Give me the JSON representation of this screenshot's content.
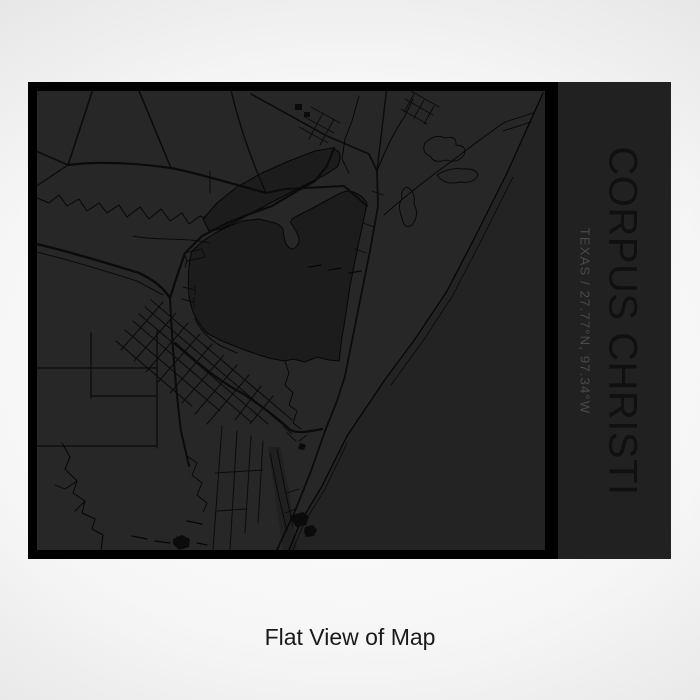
{
  "print": {
    "title": "CORPUS CHRISTI",
    "subtitle": "TEXAS / 27.77°N, 97.34°W",
    "caption": "Flat View of Map"
  },
  "colors": {
    "panel_bg": "#212121",
    "map_bg": "#272727",
    "map_border": "#000000",
    "water_bay": "#1c1c1c",
    "water_gulf": "#232323",
    "road": "#0b0b0b",
    "title_text": "#101010",
    "subtitle_text": "#4a4a4a",
    "caption_text": "#1a1a1a",
    "bg_center": "#ffffff",
    "bg_edge": "#cdcdcd"
  }
}
